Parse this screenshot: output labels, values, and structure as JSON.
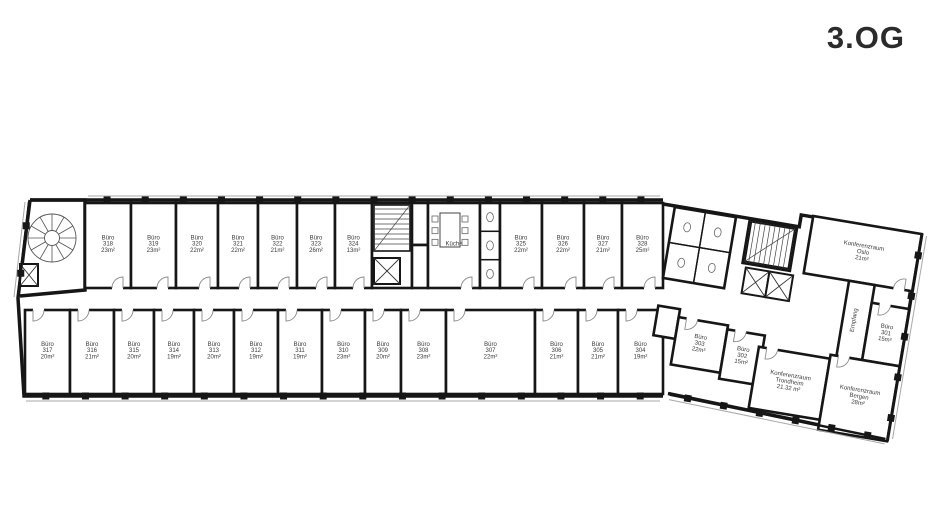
{
  "title": "3.OG",
  "colors": {
    "wall": "#161616",
    "thin": "#a8a8a8",
    "door": "#8a8a8a",
    "text": "#3a3a3a",
    "bg": "#ffffff"
  },
  "floorplan": {
    "main_rooms": [
      {
        "id": "buero-318",
        "lines": [
          "Büro",
          "318",
          "23m²"
        ],
        "x": 85,
        "y": 203,
        "w": 46,
        "h": 85,
        "door": "s"
      },
      {
        "id": "buero-319",
        "lines": [
          "Büro",
          "319",
          "23m²"
        ],
        "x": 131,
        "y": 203,
        "w": 45,
        "h": 85,
        "door": "s"
      },
      {
        "id": "buero-320",
        "lines": [
          "Büro",
          "320",
          "22m²"
        ],
        "x": 176,
        "y": 203,
        "w": 42,
        "h": 85,
        "door": "s"
      },
      {
        "id": "buero-321",
        "lines": [
          "Büro",
          "321",
          "22m²"
        ],
        "x": 218,
        "y": 203,
        "w": 40,
        "h": 85,
        "door": "s"
      },
      {
        "id": "buero-322",
        "lines": [
          "Büro",
          "322",
          "21m²"
        ],
        "x": 258,
        "y": 203,
        "w": 39,
        "h": 85,
        "door": "s"
      },
      {
        "id": "buero-323",
        "lines": [
          "Büro",
          "323",
          "26m²"
        ],
        "x": 297,
        "y": 203,
        "w": 38,
        "h": 85,
        "door": "s"
      },
      {
        "id": "buero-324",
        "lines": [
          "Büro",
          "324",
          "13m²"
        ],
        "x": 335,
        "y": 203,
        "w": 37,
        "h": 85,
        "door": "s"
      },
      {
        "id": "stairwell-mid",
        "lines": [],
        "x": 372,
        "y": 203,
        "w": 40,
        "h": 85,
        "door": null
      },
      {
        "id": "shaft-a",
        "lines": [],
        "x": 412,
        "y": 203,
        "w": 16,
        "h": 42,
        "door": null
      },
      {
        "id": "shaft-b",
        "lines": [],
        "x": 412,
        "y": 245,
        "w": 16,
        "h": 43,
        "door": null
      },
      {
        "id": "kueche",
        "lines": [
          "Küche"
        ],
        "x": 428,
        "y": 203,
        "w": 52,
        "h": 85,
        "door": "s"
      },
      {
        "id": "wc-mid",
        "lines": [],
        "x": 480,
        "y": 203,
        "w": 20,
        "h": 85,
        "door": null
      },
      {
        "id": "buero-325",
        "lines": [
          "Büro",
          "325",
          "22m²"
        ],
        "x": 500,
        "y": 203,
        "w": 42,
        "h": 85,
        "door": "s"
      },
      {
        "id": "buero-326",
        "lines": [
          "Büro",
          "326",
          "22m²"
        ],
        "x": 542,
        "y": 203,
        "w": 42,
        "h": 85,
        "door": "s"
      },
      {
        "id": "buero-327",
        "lines": [
          "Büro",
          "327",
          "21m²"
        ],
        "x": 584,
        "y": 203,
        "w": 38,
        "h": 85,
        "door": "s"
      },
      {
        "id": "buero-328",
        "lines": [
          "Büro",
          "328",
          "25m²"
        ],
        "x": 622,
        "y": 203,
        "w": 41,
        "h": 85,
        "door": "s"
      },
      {
        "id": "buero-317",
        "lines": [
          "Büro",
          "317",
          "20m²"
        ],
        "x": 25,
        "y": 310,
        "w": 45,
        "h": 84,
        "door": "n"
      },
      {
        "id": "buero-316",
        "lines": [
          "Büro",
          "316",
          "21m²"
        ],
        "x": 70,
        "y": 310,
        "w": 44,
        "h": 84,
        "door": "n"
      },
      {
        "id": "buero-315",
        "lines": [
          "Büro",
          "315",
          "20m²"
        ],
        "x": 114,
        "y": 310,
        "w": 40,
        "h": 84,
        "door": "n"
      },
      {
        "id": "buero-314",
        "lines": [
          "Büro",
          "314",
          "19m²"
        ],
        "x": 154,
        "y": 310,
        "w": 40,
        "h": 84,
        "door": "n"
      },
      {
        "id": "buero-313",
        "lines": [
          "Büro",
          "313",
          "20m²"
        ],
        "x": 194,
        "y": 310,
        "w": 40,
        "h": 84,
        "door": "n"
      },
      {
        "id": "buero-312",
        "lines": [
          "Büro",
          "312",
          "19m²"
        ],
        "x": 234,
        "y": 310,
        "w": 44,
        "h": 84,
        "door": "n"
      },
      {
        "id": "buero-311",
        "lines": [
          "Büro",
          "311",
          "19m²"
        ],
        "x": 278,
        "y": 310,
        "w": 44,
        "h": 84,
        "door": "n"
      },
      {
        "id": "buero-310",
        "lines": [
          "Büro",
          "310",
          "23m²"
        ],
        "x": 322,
        "y": 310,
        "w": 43,
        "h": 84,
        "door": "n"
      },
      {
        "id": "buero-309",
        "lines": [
          "Büro",
          "309",
          "20m²"
        ],
        "x": 365,
        "y": 310,
        "w": 36,
        "h": 84,
        "door": "n"
      },
      {
        "id": "buero-308",
        "lines": [
          "Büro",
          "308",
          "23m²"
        ],
        "x": 401,
        "y": 310,
        "w": 45,
        "h": 84,
        "door": "n"
      },
      {
        "id": "buero-307",
        "lines": [
          "Büro",
          "307",
          "22m²"
        ],
        "x": 446,
        "y": 310,
        "w": 89,
        "h": 84,
        "door": "n"
      },
      {
        "id": "buero-306",
        "lines": [
          "Büro",
          "306",
          "21m²"
        ],
        "x": 535,
        "y": 310,
        "w": 43,
        "h": 84,
        "door": "n"
      },
      {
        "id": "buero-305",
        "lines": [
          "Büro",
          "305",
          "21m²"
        ],
        "x": 578,
        "y": 310,
        "w": 40,
        "h": 84,
        "door": "n"
      },
      {
        "id": "buero-304",
        "lines": [
          "Büro",
          "304",
          "19m²"
        ],
        "x": 618,
        "y": 310,
        "w": 45,
        "h": 84,
        "door": "n"
      }
    ],
    "annex_rooms": [
      {
        "id": "konferenzraum-oslo",
        "lines": [
          "Konferenzraum",
          "Oslo",
          "21m²"
        ],
        "x": 150,
        "y": -14,
        "w": 110,
        "h": 58,
        "door": "s"
      },
      {
        "id": "empfang-area",
        "lines": [
          "Empfang"
        ],
        "x": 196,
        "y": 44,
        "w": 26,
        "h": 76,
        "door": null,
        "vertical": true
      },
      {
        "id": "buero-301",
        "lines": [
          "Büro",
          "301",
          "15m²"
        ],
        "x": 222,
        "y": 62,
        "w": 38,
        "h": 58,
        "door": "n"
      },
      {
        "id": "server-room",
        "lines": [],
        "x": 12,
        "y": 100,
        "w": 22,
        "h": 30,
        "door": null
      },
      {
        "id": "buero-303",
        "lines": [
          "Büro",
          "303",
          "22m²"
        ],
        "x": 34,
        "y": 108,
        "w": 50,
        "h": 48,
        "door": "n"
      },
      {
        "id": "buero-302",
        "lines": [
          "Büro",
          "302",
          "15m²"
        ],
        "x": 84,
        "y": 112,
        "w": 38,
        "h": 50,
        "door": "n"
      },
      {
        "id": "konferenzraum-trondheim",
        "lines": [
          "Konferenzraum",
          "Trondheim",
          "21.32 m²"
        ],
        "x": 118,
        "y": 124,
        "w": 72,
        "h": 62,
        "door": "n"
      },
      {
        "id": "konferenzraum-bergen",
        "lines": [
          "Konferenzraum",
          "Bergen",
          "28m²"
        ],
        "x": 190,
        "y": 120,
        "w": 70,
        "h": 76,
        "door": "n"
      },
      {
        "id": "wc-annex",
        "lines": [],
        "x": 12,
        "y": 0,
        "w": 62,
        "h": 72,
        "door": null
      },
      {
        "id": "stair-annex-room",
        "lines": [],
        "x": 88,
        "y": 0,
        "w": 48,
        "h": 44,
        "door": null
      }
    ],
    "features": [
      {
        "type": "spiral-stairs",
        "group": "main",
        "id": "spiral-staircase",
        "cx": 52,
        "cy": 238,
        "r": 24
      },
      {
        "type": "elevator",
        "group": "main",
        "id": "elevator-west",
        "x": 20,
        "y": 264,
        "w": 18,
        "h": 22
      },
      {
        "type": "stairs",
        "group": "main",
        "id": "staircase-mid",
        "x": 374,
        "y": 205,
        "w": 36,
        "h": 46,
        "dir": "h"
      },
      {
        "type": "elevator",
        "group": "main",
        "id": "elevator-mid",
        "x": 374,
        "y": 258,
        "w": 26,
        "h": 26
      },
      {
        "type": "table",
        "group": "main",
        "id": "kitchen-table",
        "x": 440,
        "y": 213,
        "w": 20,
        "h": 34
      },
      {
        "type": "wc-stalls",
        "group": "main",
        "id": "wc-stalls-mid",
        "x": 480,
        "y": 203,
        "w": 20,
        "h": 85,
        "n": 3
      },
      {
        "type": "wc-stalls",
        "group": "annex",
        "id": "wc-stalls-annex",
        "x": 12,
        "y": 0,
        "w": 62,
        "h": 72,
        "n": 2,
        "cols": 2
      },
      {
        "type": "stairs",
        "group": "annex",
        "id": "staircase-annex",
        "x": 90,
        "y": 2,
        "w": 44,
        "h": 40,
        "dir": "v"
      },
      {
        "type": "elevator",
        "group": "annex",
        "id": "elevator-annex-1",
        "x": 92,
        "y": 48,
        "w": 24,
        "h": 26
      },
      {
        "type": "elevator",
        "group": "annex",
        "id": "elevator-annex-2",
        "x": 116,
        "y": 48,
        "w": 24,
        "h": 26
      }
    ],
    "outlines": {
      "main": [
        "M30,200 L663,200",
        "M30,200 L18,298 L24,396 L663,396",
        "M30,200 L85,200 L85,290 L20,296"
      ],
      "annex": [
        "M0,-1 L138,-1 L138,-13 L260,-13 L260,194 L36,185"
      ]
    },
    "facades": [
      {
        "group": "main",
        "x1": 88,
        "y1": 200,
        "x2": 660,
        "y2": 200,
        "ox": 0,
        "oy": -4,
        "piers": 15
      },
      {
        "group": "main",
        "x1": 26,
        "y1": 396,
        "x2": 660,
        "y2": 396,
        "ox": 0,
        "oy": 5,
        "piers": 16
      },
      {
        "group": "main",
        "x1": 29,
        "y1": 202,
        "x2": 18,
        "y2": 297,
        "ox": -4,
        "oy": 0,
        "piers": 2
      },
      {
        "group": "annex",
        "x1": 260,
        "y1": -13,
        "x2": 260,
        "y2": 193,
        "ox": 5,
        "oy": 0,
        "piers": 5
      },
      {
        "group": "annex",
        "x1": 38,
        "y1": 186,
        "x2": 258,
        "y2": 194,
        "ox": 0,
        "oy": 5,
        "piers": 6
      }
    ],
    "annex_transform": "translate(663,205) rotate(9.5)"
  }
}
